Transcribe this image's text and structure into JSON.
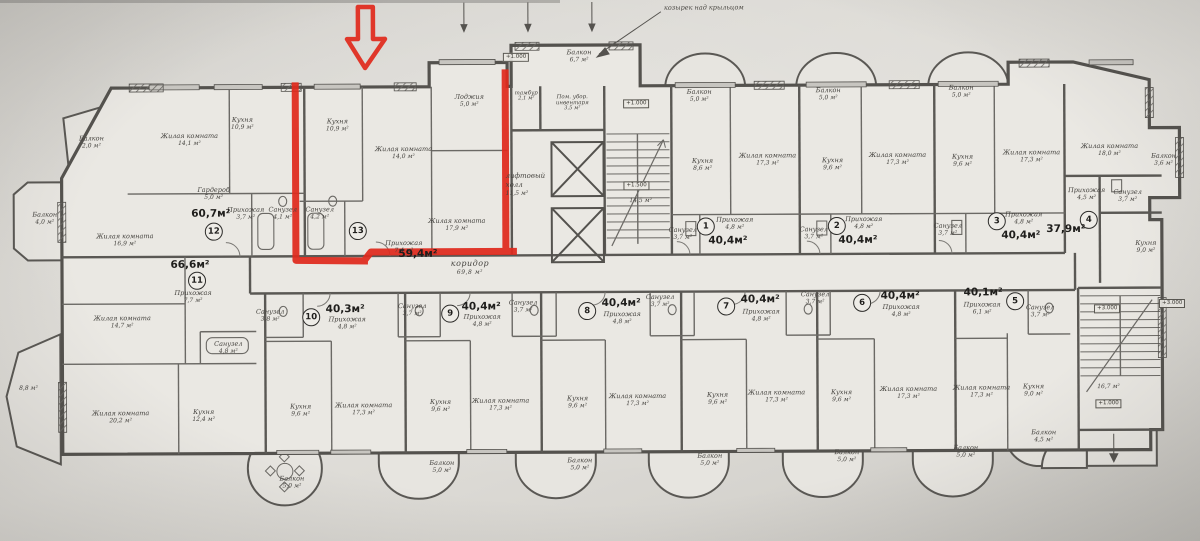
{
  "palette": {
    "paper": "#dcdad5",
    "plan_fill": "#eae8e3",
    "ink": "#54524e",
    "ink_light": "#6b6965",
    "highlight_red": "#e02a1e"
  },
  "annotation": {
    "text": "козырек над крыльцом",
    "x": 705,
    "y": 8
  },
  "apartments": [
    {
      "number": "12",
      "total": "60,7м²",
      "badge": {
        "x": 214,
        "y": 230
      },
      "total_pos": {
        "x": 211,
        "y": 212
      },
      "rooms": [
        {
          "name": "Балкон",
          "area": "2,0 м²",
          "x": 92,
          "y": 140
        },
        {
          "name": "Жилая комната",
          "area": "14,1 м²",
          "x": 190,
          "y": 138
        },
        {
          "name": "Кухня",
          "area": "10,9 м²",
          "x": 243,
          "y": 122
        },
        {
          "name": "Балкон",
          "area": "4,0 м²",
          "x": 45,
          "y": 216
        },
        {
          "name": "Жилая комната",
          "area": "16,9 м²",
          "x": 125,
          "y": 238
        },
        {
          "name": "Гардероб",
          "area": "5,0 м²",
          "x": 214,
          "y": 192
        },
        {
          "name": "Прихожая",
          "area": "3,7 м²",
          "x": 246,
          "y": 212
        },
        {
          "name": "Санузел",
          "area": "4,1 м²",
          "x": 283,
          "y": 212
        }
      ]
    },
    {
      "number": "13",
      "total": "59,4м²",
      "highlighted": true,
      "badge": {
        "x": 358,
        "y": 230
      },
      "total_pos": {
        "x": 418,
        "y": 253
      },
      "rooms": [
        {
          "name": "Кухня",
          "area": "10,9 м²",
          "x": 338,
          "y": 124
        },
        {
          "name": "Жилая комната",
          "area": "14,0 м²",
          "x": 404,
          "y": 152
        },
        {
          "name": "Лоджия",
          "area": "5,0 м²",
          "x": 470,
          "y": 100
        },
        {
          "name": "Санузел",
          "area": "4,2 м²",
          "x": 320,
          "y": 212
        },
        {
          "name": "Прихожая",
          "area": "7,4 м²",
          "x": 404,
          "y": 246
        },
        {
          "name": "Жилая комната",
          "area": "17,9 м²",
          "x": 457,
          "y": 224
        }
      ]
    },
    {
      "number": "1",
      "total": "40,4м²",
      "badge": {
        "x": 706,
        "y": 227
      },
      "total_pos": {
        "x": 728,
        "y": 241
      },
      "rooms": [
        {
          "name": "Балкон",
          "area": "5,0 м²",
          "x": 700,
          "y": 96
        },
        {
          "name": "Кухня",
          "area": "8,6 м²",
          "x": 703,
          "y": 165
        },
        {
          "name": "Жилая комната",
          "area": "17,3 м²",
          "x": 768,
          "y": 160
        },
        {
          "name": "Санузел",
          "area": "3,7 м²",
          "x": 683,
          "y": 234
        },
        {
          "name": "Прихожая",
          "area": "4,8 м²",
          "x": 735,
          "y": 224
        }
      ]
    },
    {
      "number": "2",
      "total": "40,4м²",
      "badge": {
        "x": 837,
        "y": 227
      },
      "total_pos": {
        "x": 858,
        "y": 241
      },
      "rooms": [
        {
          "name": "Балкон",
          "area": "5,0 м²",
          "x": 829,
          "y": 95
        },
        {
          "name": "Кухня",
          "area": "9,6 м²",
          "x": 833,
          "y": 165
        },
        {
          "name": "Жилая комната",
          "area": "17,3 м²",
          "x": 898,
          "y": 160
        },
        {
          "name": "Санузел",
          "area": "3,7 м²",
          "x": 814,
          "y": 234
        },
        {
          "name": "Прихожая",
          "area": "4,8 м²",
          "x": 864,
          "y": 224
        }
      ]
    },
    {
      "number": "3",
      "total": "40,4м²",
      "badge": {
        "x": 997,
        "y": 223
      },
      "total_pos": {
        "x": 1021,
        "y": 237
      },
      "rooms": [
        {
          "name": "Балкон",
          "area": "5,0 м²",
          "x": 962,
          "y": 93
        },
        {
          "name": "Кухня",
          "area": "9,6 м²",
          "x": 963,
          "y": 162
        },
        {
          "name": "Жилая комната",
          "area": "17,3 м²",
          "x": 1032,
          "y": 158
        },
        {
          "name": "Санузел",
          "area": "3,7 м²",
          "x": 948,
          "y": 231
        },
        {
          "name": "Прихожая",
          "area": "4,8 м²",
          "x": 1024,
          "y": 220
        }
      ]
    },
    {
      "number": "4",
      "total": "37,9м²",
      "badge": {
        "x": 1089,
        "y": 222
      },
      "total_pos": {
        "x": 1066,
        "y": 231
      },
      "rooms": [
        {
          "name": "Жилая комната",
          "area": "18,0 м²",
          "x": 1110,
          "y": 152
        },
        {
          "name": "Балкон",
          "area": "3,6 м²",
          "x": 1164,
          "y": 162
        },
        {
          "name": "Прихожая",
          "area": "4,5 м²",
          "x": 1087,
          "y": 196
        },
        {
          "name": "Санузел",
          "area": "3,7 м²",
          "x": 1128,
          "y": 198
        },
        {
          "name": "Кухня",
          "area": "9,0 м²",
          "x": 1146,
          "y": 249
        }
      ]
    },
    {
      "number": "11",
      "total": "66,6м²",
      "badge": {
        "x": 197,
        "y": 279
      },
      "total_pos": {
        "x": 190,
        "y": 263
      },
      "rooms": [
        {
          "name": "Прихожая",
          "area": "7,7 м²",
          "x": 193,
          "y": 295
        },
        {
          "name": "Жилая комната",
          "area": "14,7 м²",
          "x": 122,
          "y": 320
        },
        {
          "name": "Санузел",
          "area": "4,8 м²",
          "x": 228,
          "y": 346
        },
        {
          "name": "Жилая комната",
          "area": "20,2 м²",
          "x": 120,
          "y": 415
        },
        {
          "name": "Кухня",
          "area": "12,4 м²",
          "x": 203,
          "y": 414
        },
        {
          "name": "",
          "area": "8,8 м²",
          "x": 28,
          "y": 386
        },
        {
          "name": "Балкон",
          "area": "5,0 м²",
          "x": 291,
          "y": 481
        }
      ]
    },
    {
      "number": "10",
      "total": "40,3м²",
      "badge": {
        "x": 311,
        "y": 316
      },
      "total_pos": {
        "x": 345,
        "y": 308
      },
      "rooms": [
        {
          "name": "Прихожая",
          "area": "4,8 м²",
          "x": 347,
          "y": 322
        },
        {
          "name": "Санузел",
          "area": "3,8 м²",
          "x": 270,
          "y": 314
        },
        {
          "name": "Кухня",
          "area": "9,6 м²",
          "x": 300,
          "y": 409
        },
        {
          "name": "Жилая комната",
          "area": "17,3 м²",
          "x": 363,
          "y": 408
        },
        {
          "name": "Балкон",
          "area": "5,0 м²",
          "x": 441,
          "y": 466
        }
      ]
    },
    {
      "number": "9",
      "total": "40,4м²",
      "badge": {
        "x": 450,
        "y": 313
      },
      "total_pos": {
        "x": 481,
        "y": 306
      },
      "rooms": [
        {
          "name": "Прихожая",
          "area": "4,8 м²",
          "x": 482,
          "y": 320
        },
        {
          "name": "Санузел",
          "area": "3,7 м²",
          "x": 412,
          "y": 309
        },
        {
          "name": "Кухня",
          "area": "9,6 м²",
          "x": 440,
          "y": 405
        },
        {
          "name": "Жилая комната",
          "area": "17,3 м²",
          "x": 500,
          "y": 404
        },
        {
          "name": "Балкон",
          "area": "5,0 м²",
          "x": 579,
          "y": 464
        }
      ]
    },
    {
      "number": "8",
      "total": "40,4м²",
      "badge": {
        "x": 587,
        "y": 311
      },
      "total_pos": {
        "x": 621,
        "y": 303
      },
      "rooms": [
        {
          "name": "Прихожая",
          "area": "4,8 м²",
          "x": 622,
          "y": 318
        },
        {
          "name": "Санузел",
          "area": "3,7 м²",
          "x": 523,
          "y": 306
        },
        {
          "name": "Кухня",
          "area": "9,6 м²",
          "x": 577,
          "y": 402
        },
        {
          "name": "Жилая комната",
          "area": "17,3 м²",
          "x": 637,
          "y": 400
        },
        {
          "name": "Балкон",
          "area": "5,0 м²",
          "x": 709,
          "y": 460
        }
      ]
    },
    {
      "number": "7",
      "total": "40,4м²",
      "badge": {
        "x": 726,
        "y": 307
      },
      "total_pos": {
        "x": 760,
        "y": 300
      },
      "rooms": [
        {
          "name": "Прихожая",
          "area": "4,8 м²",
          "x": 761,
          "y": 316
        },
        {
          "name": "Санузел",
          "area": "3,7 м²",
          "x": 660,
          "y": 301
        },
        {
          "name": "Кухня",
          "area": "9,6 м²",
          "x": 717,
          "y": 399
        },
        {
          "name": "Жилая комната",
          "area": "17,3 м²",
          "x": 776,
          "y": 397
        },
        {
          "name": "Балкон",
          "area": "5,0 м²",
          "x": 846,
          "y": 457
        }
      ]
    },
    {
      "number": "6",
      "total": "40,4м²",
      "badge": {
        "x": 862,
        "y": 304
      },
      "total_pos": {
        "x": 900,
        "y": 297
      },
      "rooms": [
        {
          "name": "Прихожая",
          "area": "4,8 м²",
          "x": 901,
          "y": 312
        },
        {
          "name": "Санузел",
          "area": "3,7 м²",
          "x": 815,
          "y": 299
        },
        {
          "name": "Кухня",
          "area": "9,6 м²",
          "x": 841,
          "y": 397
        },
        {
          "name": "Жилая комната",
          "area": "17,3 м²",
          "x": 908,
          "y": 394
        },
        {
          "name": "Балкон",
          "area": "5,0 м²",
          "x": 965,
          "y": 453
        }
      ]
    },
    {
      "number": "5",
      "total": "40,1м²",
      "badge": {
        "x": 1015,
        "y": 303
      },
      "total_pos": {
        "x": 983,
        "y": 294
      },
      "rooms": [
        {
          "name": "Прихожая",
          "area": "6,1 м²",
          "x": 982,
          "y": 310
        },
        {
          "name": "Санузел",
          "area": "3,7 м²",
          "x": 1040,
          "y": 313
        },
        {
          "name": "Жилая комната",
          "area": "17,3 м²",
          "x": 981,
          "y": 393
        },
        {
          "name": "Кухня",
          "area": "9,0 м²",
          "x": 1033,
          "y": 392
        },
        {
          "name": "Балкон",
          "area": "4,5 м²",
          "x": 1043,
          "y": 438
        }
      ]
    }
  ],
  "common_areas": [
    {
      "name": "тамбур",
      "area": "2,1 м²",
      "x": 527,
      "y": 96,
      "cls": "tiny"
    },
    {
      "name": "Пом. убор. инвентаря",
      "area": "3,5 м²",
      "x": 573,
      "y": 103,
      "cls": "tiny wrap"
    },
    {
      "name": "Балкон",
      "area": "6,7 м²",
      "x": 580,
      "y": 56,
      "cls": ""
    },
    {
      "name": "лифтовый холл",
      "area": "11,5 м²",
      "x": 534,
      "y": 184,
      "cls": "hall"
    },
    {
      "name": "коридор",
      "area": "69,8 м²",
      "x": 470,
      "y": 267,
      "cls": "corr"
    },
    {
      "name": "",
      "area": "14,5 м²",
      "x": 641,
      "y": 201,
      "cls": ""
    },
    {
      "name": "",
      "area": "16,7 м²",
      "x": 1108,
      "y": 389,
      "cls": ""
    }
  ],
  "elevation_marks": [
    {
      "text": "+1.000",
      "x": 517,
      "y": 57
    },
    {
      "text": "+1.000",
      "x": 637,
      "y": 104
    },
    {
      "text": "+1.500",
      "x": 637,
      "y": 186
    },
    {
      "text": "+3.000",
      "x": 1107,
      "y": 311
    },
    {
      "text": "+3.000",
      "x": 1172,
      "y": 306
    },
    {
      "text": "+1.000",
      "x": 1108,
      "y": 406
    }
  ]
}
